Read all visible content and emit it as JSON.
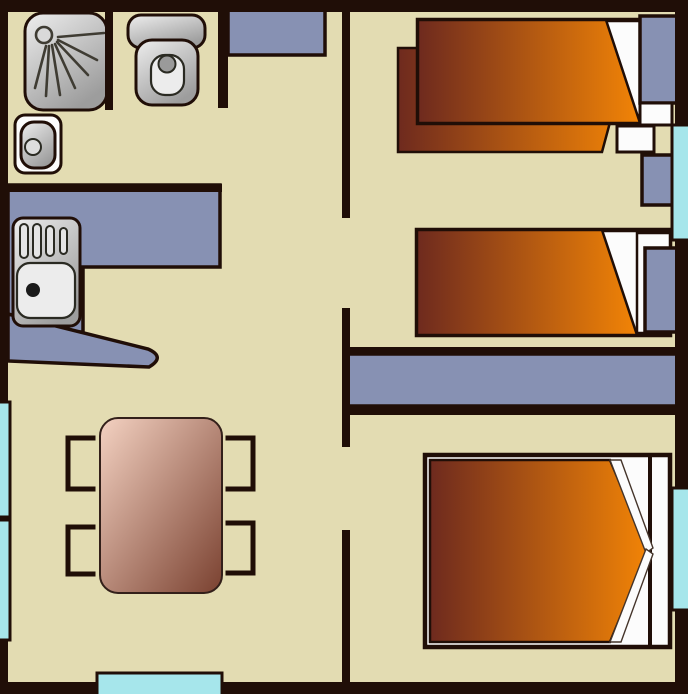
{
  "colors": {
    "floor": "#e3dcb2",
    "wall": "#200e07",
    "furniture_blue": "#8791b3",
    "window_cyan": "#a6e6eb",
    "white": "#fcfcfc",
    "bed_dark": "#6e2a1e",
    "bed_orange": "#f28406",
    "table_light": "#f4d2c2",
    "table_dark": "#7a4130",
    "fixture_light": "#eeeeee",
    "fixture_dark": "#9d9d9d",
    "spray": "#3f3c33",
    "sink_dot": "#1a1a1a"
  },
  "scene": {
    "type": "floor-plan",
    "rooms": {
      "bathroom": [
        "shower",
        "washbasin",
        "toilet"
      ],
      "kitchen": [
        "l-shaped-counter",
        "sink-unit",
        "peninsula-counter"
      ],
      "living-area": [
        "dining-table",
        "chair",
        "chair",
        "chair",
        "chair",
        "entrance-door"
      ],
      "bedroom-top-right": [
        "single-bed",
        "single-bed",
        "nightstand",
        "nightstand",
        "wardrobe"
      ],
      "bedroom-middle-right": [
        "single-bed",
        "nightstand",
        "wardrobe-strip"
      ],
      "bedroom-bottom-right": [
        "double-bed"
      ]
    },
    "window_count": 4,
    "door_count": 1
  }
}
